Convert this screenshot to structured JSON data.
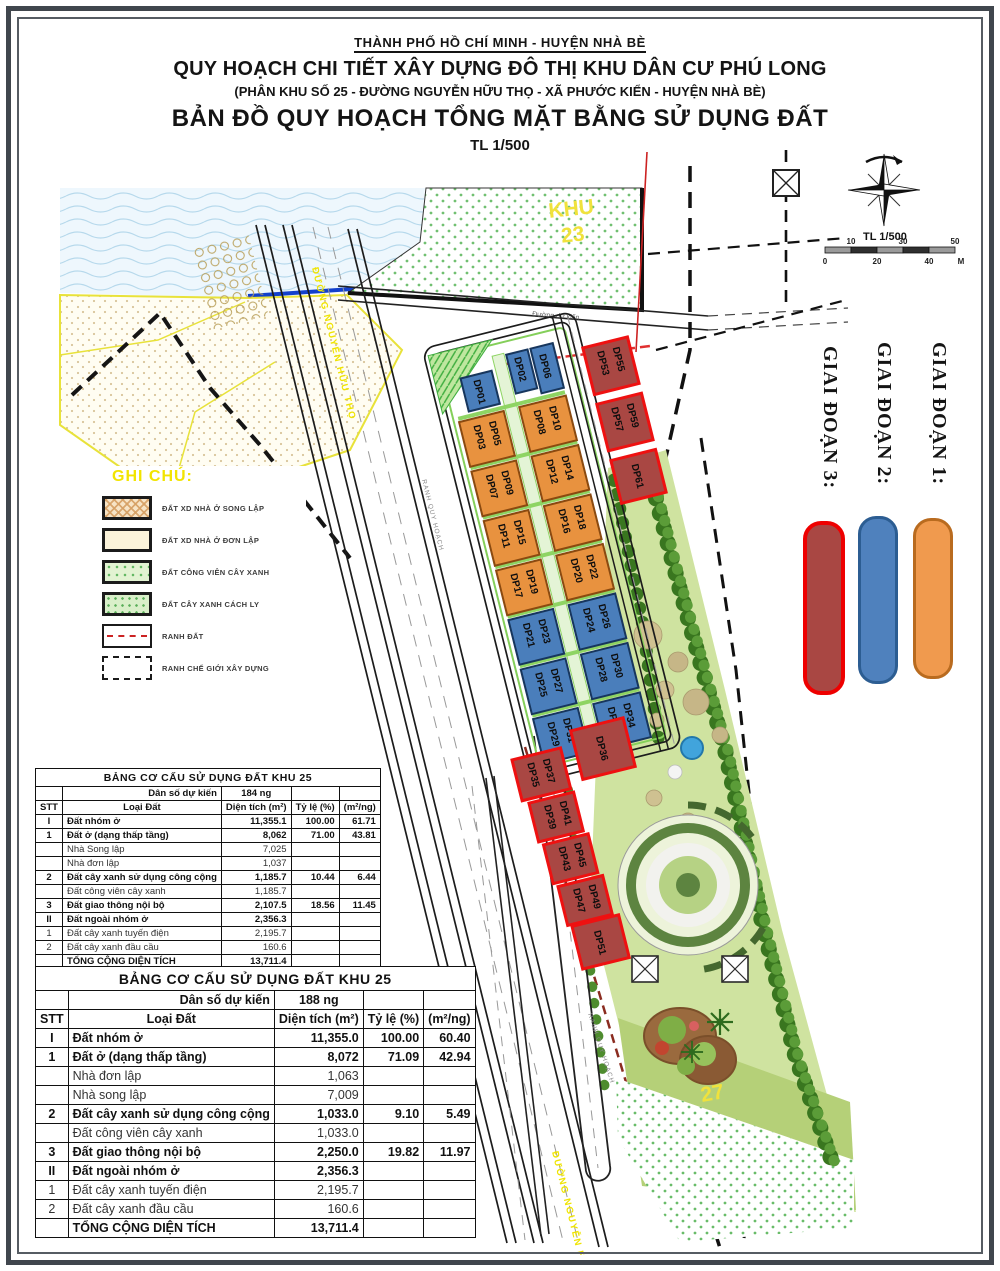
{
  "header": {
    "line1": "THÀNH PHỐ HỒ CHÍ MINH - HUYỆN NHÀ BÈ",
    "line2": "QUY HOẠCH CHI TIẾT XÂY DỰNG ĐÔ THỊ KHU DÂN CƯ PHÚ LONG",
    "line3": "(PHÂN KHU SỐ 25 - ĐƯỜNG NGUYỄN HỮU THỌ - XÃ PHƯỚC KIỂN - HUYỆN NHÀ BÈ)",
    "line4": "BẢN ĐỒ QUY HOẠCH TỔNG MẶT BẰNG SỬ DỤNG ĐẤT",
    "line5": "TL 1/500"
  },
  "map": {
    "khu23_word": "KHU",
    "khu23_num": "23",
    "khu27_num": "27",
    "main_road_label": "ĐƯỜNG NGUYỄN HỮU THỌ",
    "planned_road_label": "Đường dự kiến",
    "boundary_label": "RANH QUY HOẠCH",
    "scale": {
      "title": "TL 1/500",
      "ticks": [
        "0",
        "10",
        "20",
        "30",
        "40",
        "50",
        "M"
      ]
    },
    "lots": {
      "l01": "DP01",
      "l02": "DP02",
      "l06": "DP06",
      "l03": "DP03",
      "l05": "DP05",
      "l07": "DP07",
      "l09": "DP09",
      "l11": "DP11",
      "l15": "DP15",
      "l17": "DP17",
      "l19": "DP19",
      "l21": "DP21",
      "l23": "DP23",
      "l25": "DP25",
      "l27": "DP27",
      "l29": "DP29",
      "l31": "DP31",
      "l08": "DP08",
      "l10": "DP10",
      "l12": "DP12",
      "l14": "DP14",
      "l16": "DP16",
      "l18": "DP18",
      "l20": "DP20",
      "l22": "DP22",
      "l24": "DP24",
      "l26": "DP26",
      "l28": "DP28",
      "l30": "DP30",
      "l32": "DP32",
      "l34": "DP34",
      "l53": "DP53",
      "l55": "DP55",
      "l57": "DP57",
      "l59": "DP59",
      "l61": "DP61",
      "l35": "DP35",
      "l37": "DP37",
      "l36": "DP36",
      "l39": "DP39",
      "l41": "DP41",
      "l43": "DP43",
      "l45": "DP45",
      "l47": "DP47",
      "l49": "DP49",
      "l51": "DP51"
    },
    "phase_colors": {
      "phase1": "#f09a4e",
      "phase2": "#4f81bd",
      "phase3": "#a94743",
      "phase3_border": "#ee0000"
    }
  },
  "phases": [
    {
      "label": "GIAI ĐOẠN 1:"
    },
    {
      "label": "GIAI ĐOẠN 2:"
    },
    {
      "label": "GIAI ĐOẠN 3:"
    }
  ],
  "ghi_chu": {
    "title": "GHI CHÚ:",
    "items": [
      {
        "label": "ĐẤT XD NHÀ Ở SONG LẬP",
        "type": "hatch"
      },
      {
        "label": "ĐẤT XD NHÀ Ở ĐƠN LẬP",
        "type": "plain"
      },
      {
        "label": "ĐẤT CÔNG VIÊN CÂY XANH",
        "type": "dots"
      },
      {
        "label": "ĐẤT CÂY XANH CÁCH LY",
        "type": "dots2"
      },
      {
        "label": "RANH ĐẤT",
        "type": "redline"
      },
      {
        "label": "RANH CHẾ GIỚI XÂY DỰNG",
        "type": "dashed"
      }
    ]
  },
  "tables": [
    {
      "title": "BẢNG CƠ CẤU SỬ DỤNG ĐẤT KHU 25",
      "pop_label": "Dân số dự kiến",
      "pop_value": "184 ng",
      "col_headers": [
        "STT",
        "Loại Đất",
        "Diện tích (m²)",
        "Tỷ lệ (%)",
        "(m²/ng)"
      ],
      "rows": [
        {
          "stt": "I",
          "name": "Đất nhóm ở",
          "area": "11,355.1",
          "pct": "100.00",
          "per": "61.71",
          "cls": "sec"
        },
        {
          "stt": "1",
          "name": "Đất ở (dạng thấp tầng)",
          "area": "8,062",
          "pct": "71.00",
          "per": "43.81",
          "cls": "sec"
        },
        {
          "stt": "",
          "name": "Nhà Song lập",
          "area": "7,025",
          "pct": "",
          "per": "",
          "cls": "sub"
        },
        {
          "stt": "",
          "name": "Nhà đơn lập",
          "area": "1,037",
          "pct": "",
          "per": "",
          "cls": "sub"
        },
        {
          "stt": "2",
          "name": "Đất cây xanh sử dụng công cộng",
          "area": "1,185.7",
          "pct": "10.44",
          "per": "6.44",
          "cls": "sec"
        },
        {
          "stt": "",
          "name": "Đất công viên cây xanh",
          "area": "1,185.7",
          "pct": "",
          "per": "",
          "cls": "sub"
        },
        {
          "stt": "3",
          "name": "Đất giao thông nội bộ",
          "area": "2,107.5",
          "pct": "18.56",
          "per": "11.45",
          "cls": "sec"
        },
        {
          "stt": "II",
          "name": "Đất ngoài nhóm ở",
          "area": "2,356.3",
          "pct": "",
          "per": "",
          "cls": "sec"
        },
        {
          "stt": "1",
          "name": "Đất cây xanh tuyến điện",
          "area": "2,195.7",
          "pct": "",
          "per": "",
          "cls": "sub"
        },
        {
          "stt": "2",
          "name": "Đất cây xanh đầu cầu",
          "area": "160.6",
          "pct": "",
          "per": "",
          "cls": "sub"
        },
        {
          "stt": "",
          "name": "TỔNG CỘNG DIỆN TÍCH",
          "area": "13,711.4",
          "pct": "",
          "per": "",
          "cls": "tot"
        }
      ]
    },
    {
      "title": "BẢNG CƠ CẤU SỬ DỤNG ĐẤT KHU 25",
      "pop_label": "Dân số dự kiến",
      "pop_value": "188 ng",
      "col_headers": [
        "STT",
        "Loại Đất",
        "Diện tích (m²)",
        "Tỷ lệ (%)",
        "(m²/ng)"
      ],
      "rows": [
        {
          "stt": "I",
          "name": "Đất nhóm ở",
          "area": "11,355.0",
          "pct": "100.00",
          "per": "60.40",
          "cls": "sec"
        },
        {
          "stt": "1",
          "name": "Đất ở (dạng thấp tầng)",
          "area": "8,072",
          "pct": "71.09",
          "per": "42.94",
          "cls": "sec"
        },
        {
          "stt": "",
          "name": "Nhà đơn lập",
          "area": "1,063",
          "pct": "",
          "per": "",
          "cls": "sub"
        },
        {
          "stt": "",
          "name": "Nhà song lập",
          "area": "7,009",
          "pct": "",
          "per": "",
          "cls": "sub"
        },
        {
          "stt": "2",
          "name": "Đất cây xanh sử dụng công cộng",
          "area": "1,033.0",
          "pct": "9.10",
          "per": "5.49",
          "cls": "sec"
        },
        {
          "stt": "",
          "name": "Đất công viên cây xanh",
          "area": "1,033.0",
          "pct": "",
          "per": "",
          "cls": "sub"
        },
        {
          "stt": "3",
          "name": "Đất giao thông nội bộ",
          "area": "2,250.0",
          "pct": "19.82",
          "per": "11.97",
          "cls": "sec"
        },
        {
          "stt": "II",
          "name": "Đất ngoài nhóm ở",
          "area": "2,356.3",
          "pct": "",
          "per": "",
          "cls": "sec"
        },
        {
          "stt": "1",
          "name": "Đất cây xanh tuyến điện",
          "area": "2,195.7",
          "pct": "",
          "per": "",
          "cls": "sub"
        },
        {
          "stt": "2",
          "name": "Đất cây xanh đầu cầu",
          "area": "160.6",
          "pct": "",
          "per": "",
          "cls": "sub"
        },
        {
          "stt": "",
          "name": "TỔNG CỘNG DIỆN TÍCH",
          "area": "13,711.4",
          "pct": "",
          "per": "",
          "cls": "tot"
        }
      ]
    }
  ]
}
